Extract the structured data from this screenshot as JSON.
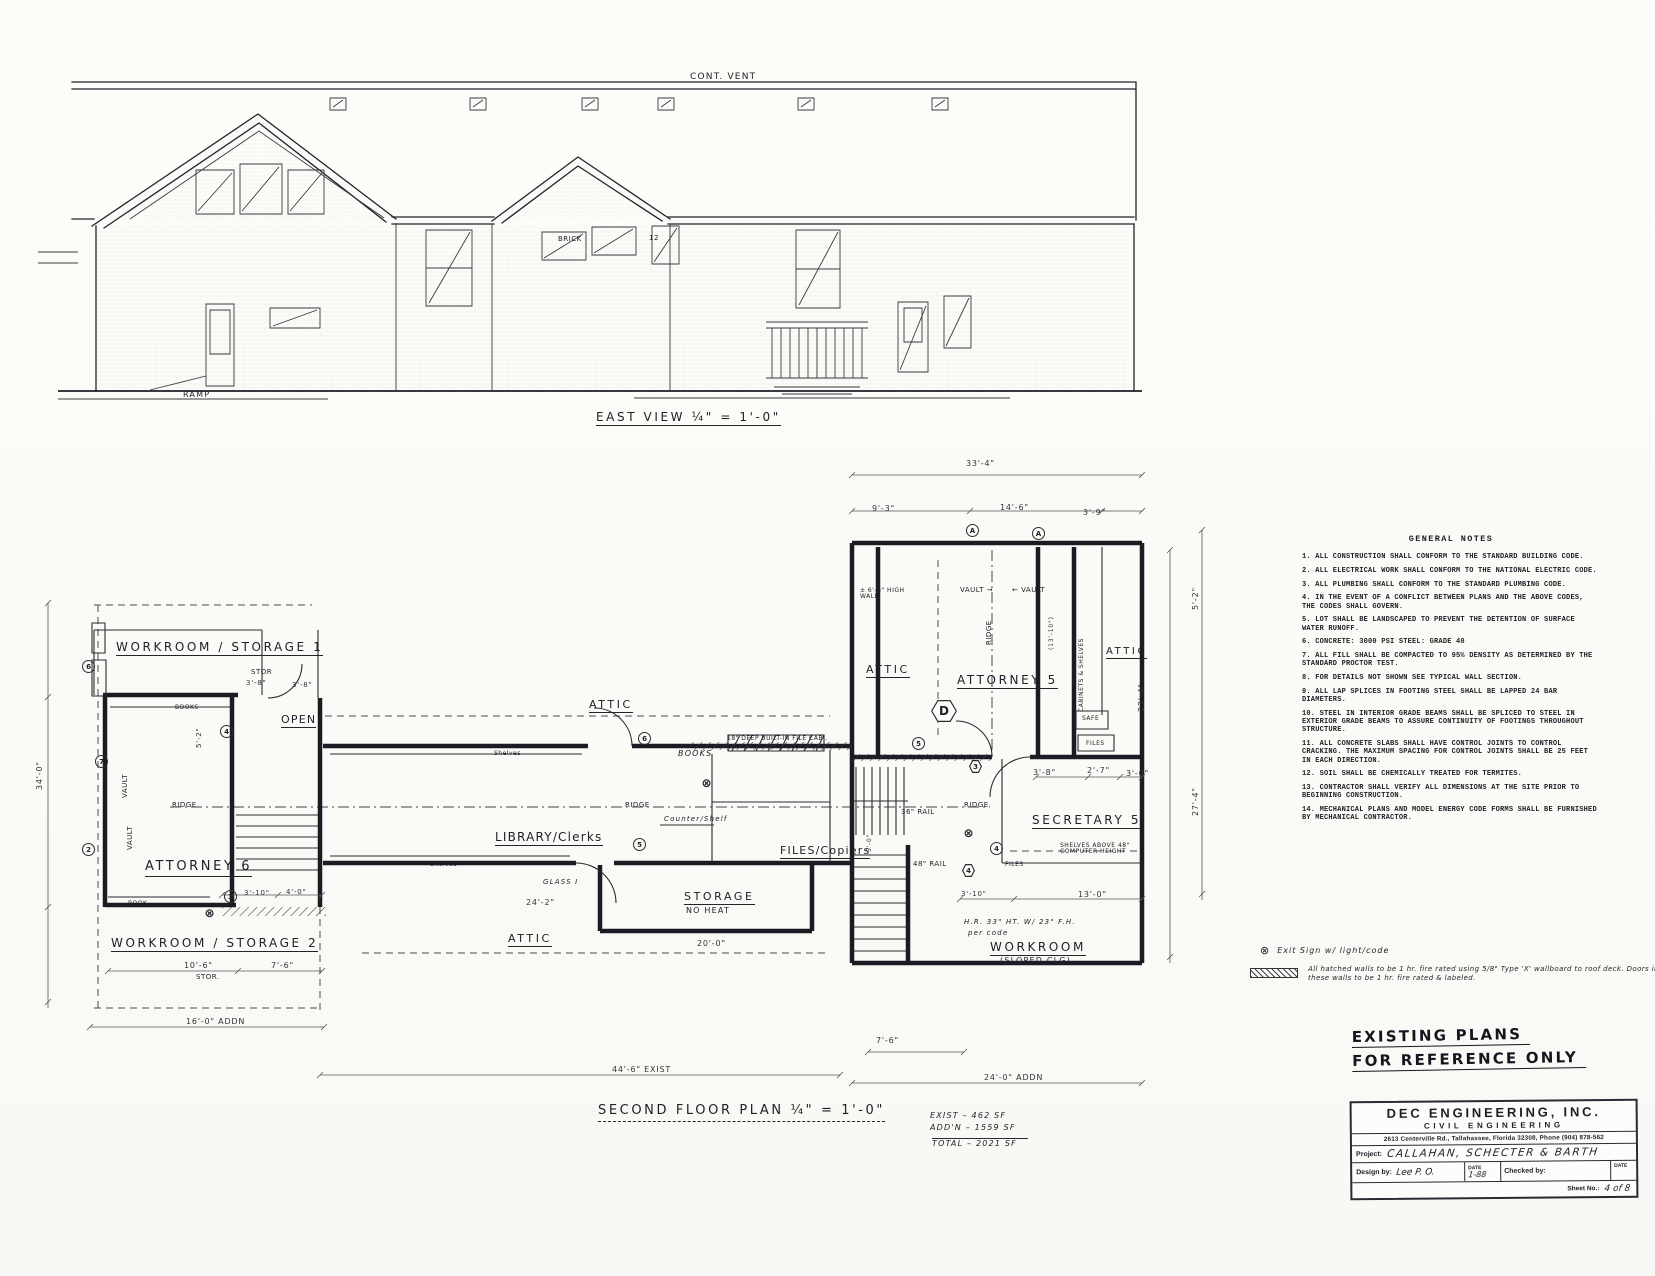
{
  "colors": {
    "ink": "#22222a",
    "paper": "#fbfbf8"
  },
  "general_notes": {
    "title": "GENERAL NOTES",
    "items": [
      "1.  ALL CONSTRUCTION SHALL CONFORM TO THE STANDARD BUILDING CODE.",
      "2.  ALL ELECTRICAL WORK SHALL CONFORM TO THE NATIONAL ELECTRIC CODE.",
      "3.  ALL PLUMBING SHALL CONFORM TO THE STANDARD PLUMBING CODE.",
      "4.  IN THE EVENT OF A CONFLICT BETWEEN PLANS AND THE ABOVE CODES, THE CODES SHALL GOVERN.",
      "5.  LOT SHALL BE LANDSCAPED TO PREVENT THE DETENTION OF SURFACE WATER RUNOFF.",
      "6.  CONCRETE: 3000 PSI    STEEL: GRADE 40",
      "7.  ALL FILL SHALL BE COMPACTED TO 95% DENSITY AS DETERMINED BY THE STANDARD PROCTOR TEST.",
      "8.  FOR DETAILS NOT SHOWN SEE TYPICAL WALL SECTION.",
      "9.  ALL LAP SPLICES IN FOOTING STEEL SHALL BE LAPPED 24 BAR DIAMETERS.",
      "10. STEEL IN INTERIOR GRADE BEAMS SHALL BE SPLICED TO STEEL IN EXTERIOR GRADE BEAMS TO ASSURE CONTINUITY OF FOOTINGS THROUGHOUT STRUCTURE.",
      "11. ALL CONCRETE SLABS SHALL HAVE CONTROL JOINTS TO CONTROL CRACKING.  THE MAXIMUM SPACING FOR CONTROL JOINTS SHALL BE 25 FEET IN EACH DIRECTION.",
      "12. SOIL SHALL BE CHEMICALLY TREATED FOR TERMITES.",
      "13. CONTRACTOR SHALL VERIFY ALL DIMENSIONS AT THE SITE PRIOR TO BEGINNING CONSTRUCTION.",
      "14. MECHANICAL PLANS AND MODEL ENERGY CODE FORMS SHALL BE FURNISHED BY MECHANICAL CONTRACTOR."
    ]
  },
  "legend": {
    "exit_symbol": "⊗",
    "exit_text": "Exit Sign w/ light/code",
    "hatch_text": "All hatched walls to be 1 hr. fire rated using 5/8\" Type 'X' wallboard to roof deck.  Doors in these walls to be 1 hr. fire rated & labeled."
  },
  "stamp": {
    "line1": "EXISTING PLANS",
    "line2": "FOR REFERENCE ONLY"
  },
  "title_block": {
    "company": "DEC  ENGINEERING,  INC.",
    "dept": "CIVIL ENGINEERING",
    "address": "2613 Centerville Rd., Tallahassee, Florida 32308, Phone (904) 878-562",
    "project_label": "Project:",
    "project": "CALLAHAN, SCHECTER & BARTH",
    "design_label": "Design by:",
    "design_sig": "Lee P. O.",
    "date_label": "DATE",
    "date_value": "1-88",
    "checked_label": "Checked by:",
    "date2_label": "DATE",
    "sheet_label": "Sheet No.:",
    "sheet_value": "4 of 8"
  },
  "area_summary": {
    "exist": "462 SF",
    "addition": "1559 SF",
    "total": "2021 SF"
  },
  "labels": [
    {
      "t": "CONT. VENT",
      "x": 690,
      "y": 72,
      "fs": 9,
      "cls": "hand"
    },
    {
      "t": "EAST VIEW  ¼\" = 1'-0\"",
      "x": 596,
      "y": 411,
      "fs": 12,
      "cls": "hand sp ul"
    },
    {
      "t": "RAMP",
      "x": 183,
      "y": 391,
      "fs": 8,
      "cls": "hand"
    },
    {
      "t": "12",
      "x": 649,
      "y": 235,
      "fs": 7
    },
    {
      "t": "BRICK",
      "x": 558,
      "y": 236,
      "fs": 7
    },
    {
      "t": "SECOND FLOOR PLAN  ¼\" = 1'-0\"",
      "x": 598,
      "y": 1104,
      "fs": 13,
      "cls": "hand sp ud"
    },
    {
      "t": "WORKROOM / STORAGE  1",
      "x": 116,
      "y": 641,
      "fs": 12,
      "cls": "hand sp ul"
    },
    {
      "t": "OPEN",
      "x": 281,
      "y": 714,
      "fs": 11,
      "cls": "hand ul"
    },
    {
      "t": "ATTORNEY 6",
      "x": 145,
      "y": 860,
      "fs": 13,
      "cls": "hand sp ul"
    },
    {
      "t": "WORKROOM / STORAGE  2",
      "x": 111,
      "y": 937,
      "fs": 12,
      "cls": "hand sp ul"
    },
    {
      "t": "ATTIC",
      "x": 589,
      "y": 699,
      "fs": 11,
      "cls": "hand sp ul"
    },
    {
      "t": "ATTIC",
      "x": 508,
      "y": 933,
      "fs": 11,
      "cls": "hand sp ul"
    },
    {
      "t": "LIBRARY/Clerks",
      "x": 495,
      "y": 831,
      "fs": 12,
      "cls": "hand ul"
    },
    {
      "t": "STORAGE",
      "x": 684,
      "y": 891,
      "fs": 11,
      "cls": "hand sp ul"
    },
    {
      "t": "NO HEAT",
      "x": 686,
      "y": 907,
      "fs": 8,
      "cls": "hand"
    },
    {
      "t": "FILES/Copiers",
      "x": 780,
      "y": 845,
      "fs": 11,
      "cls": "hand ul"
    },
    {
      "t": "ATTIC",
      "x": 866,
      "y": 664,
      "fs": 11,
      "cls": "hand sp ul"
    },
    {
      "t": "ATTORNEY  5",
      "x": 957,
      "y": 674,
      "fs": 12,
      "cls": "hand sp ul"
    },
    {
      "t": "ATTIC",
      "x": 1106,
      "y": 646,
      "fs": 10,
      "cls": "hand sp ul"
    },
    {
      "t": "SECRETARY  5",
      "x": 1032,
      "y": 814,
      "fs": 12,
      "cls": "hand sp ul"
    },
    {
      "t": "WORKROOM",
      "x": 990,
      "y": 941,
      "fs": 12,
      "cls": "hand sp ul"
    },
    {
      "t": "(SLOPED CLG)",
      "x": 1000,
      "y": 957,
      "fs": 8,
      "cls": "hand"
    },
    {
      "t": "STOR",
      "x": 251,
      "y": 669,
      "fs": 7
    },
    {
      "t": "3'-8\"",
      "x": 246,
      "y": 680,
      "fs": 7,
      "cls": "dim"
    },
    {
      "t": "3'-8\"",
      "x": 292,
      "y": 682,
      "fs": 7,
      "cls": "dim"
    },
    {
      "t": "BOOKS",
      "x": 175,
      "y": 705,
      "fs": 6
    },
    {
      "t": "BOOKS",
      "x": 678,
      "y": 750,
      "fs": 8,
      "cls": "hand it"
    },
    {
      "t": "18\" DEEP BUILT-IN FILE CABI.",
      "x": 727,
      "y": 736,
      "fs": 6
    },
    {
      "t": "RIDGE",
      "x": 172,
      "y": 802,
      "fs": 7
    },
    {
      "t": "RIDGE",
      "x": 625,
      "y": 802,
      "fs": 7
    },
    {
      "t": "RIDGE",
      "x": 964,
      "y": 802,
      "fs": 7
    },
    {
      "t": "RIDGE",
      "x": 986,
      "y": 645,
      "fs": 7,
      "cls": "rot"
    },
    {
      "t": "VAULT",
      "x": 122,
      "y": 798,
      "fs": 7,
      "cls": "rot"
    },
    {
      "t": "VAULT",
      "x": 127,
      "y": 850,
      "fs": 7,
      "cls": "rot"
    },
    {
      "t": "VAULT →",
      "x": 960,
      "y": 587,
      "fs": 7
    },
    {
      "t": "← VAULT",
      "x": 1012,
      "y": 587,
      "fs": 7
    },
    {
      "t": "± 6'-6\" HIGH WALL",
      "x": 860,
      "y": 588,
      "fs": 6,
      "w": 60,
      "cls": "wrap"
    },
    {
      "t": "CABINETS & SHELVES",
      "x": 1079,
      "y": 712,
      "fs": 6,
      "cls": "rot"
    },
    {
      "t": "SAFE",
      "x": 1082,
      "y": 716,
      "fs": 6
    },
    {
      "t": "FILES",
      "x": 1086,
      "y": 741,
      "fs": 6
    },
    {
      "t": "FILES",
      "x": 1005,
      "y": 862,
      "fs": 6
    },
    {
      "t": "SHELVES ABOVE 48\" COMPUTER HEIGHT",
      "x": 1060,
      "y": 843,
      "fs": 6,
      "w": 80,
      "cls": "wrap"
    },
    {
      "t": "36\" RAIL",
      "x": 901,
      "y": 809,
      "fs": 7
    },
    {
      "t": "48\" RAIL",
      "x": 913,
      "y": 861,
      "fs": 7
    },
    {
      "t": "H.R. 33\" HT. W/ 23\" F.H.",
      "x": 964,
      "y": 919,
      "fs": 7,
      "cls": "hand it"
    },
    {
      "t": "per code",
      "x": 968,
      "y": 930,
      "fs": 7,
      "cls": "hand it"
    },
    {
      "t": "Counter/Shelf",
      "x": 664,
      "y": 816,
      "fs": 7,
      "cls": "hand it"
    },
    {
      "t": "GLASS I",
      "x": 543,
      "y": 879,
      "fs": 7,
      "cls": "hand it"
    },
    {
      "t": "Shelves",
      "x": 430,
      "y": 862,
      "fs": 6
    },
    {
      "t": "Shelves",
      "x": 494,
      "y": 751,
      "fs": 6
    },
    {
      "t": "BOOK",
      "x": 128,
      "y": 901,
      "fs": 6
    },
    {
      "t": "STOR.",
      "x": 196,
      "y": 974,
      "fs": 7
    },
    {
      "t": "33'-4\"",
      "x": 966,
      "y": 460,
      "fs": 8,
      "cls": "dim"
    },
    {
      "t": "9'-3\"",
      "x": 872,
      "y": 505,
      "fs": 8,
      "cls": "dim"
    },
    {
      "t": "14'-6\"",
      "x": 1000,
      "y": 504,
      "fs": 8,
      "cls": "dim"
    },
    {
      "t": "3'-9\"",
      "x": 1083,
      "y": 509,
      "fs": 8,
      "cls": "dim"
    },
    {
      "t": "5'-2\"",
      "x": 196,
      "y": 748,
      "fs": 7,
      "cls": "dim rot"
    },
    {
      "t": "16'-0\"  ADDN",
      "x": 186,
      "y": 1018,
      "fs": 8,
      "cls": "dim"
    },
    {
      "t": "44'-6\"    EXIST",
      "x": 612,
      "y": 1066,
      "fs": 8,
      "cls": "dim"
    },
    {
      "t": "24'-0\"  ADDN",
      "x": 984,
      "y": 1074,
      "fs": 8,
      "cls": "dim"
    },
    {
      "t": "7'-6\"",
      "x": 876,
      "y": 1037,
      "fs": 8,
      "cls": "dim"
    },
    {
      "t": "10'-6\"",
      "x": 184,
      "y": 962,
      "fs": 8,
      "cls": "dim"
    },
    {
      "t": "7'-6\"",
      "x": 271,
      "y": 962,
      "fs": 8,
      "cls": "dim"
    },
    {
      "t": "24'-2\"",
      "x": 526,
      "y": 899,
      "fs": 8,
      "cls": "dim"
    },
    {
      "t": "20'-0\"",
      "x": 697,
      "y": 940,
      "fs": 8,
      "cls": "dim"
    },
    {
      "t": "13'-0\"",
      "x": 1078,
      "y": 891,
      "fs": 8,
      "cls": "dim"
    },
    {
      "t": "3'-10\"",
      "x": 961,
      "y": 891,
      "fs": 7,
      "cls": "dim"
    },
    {
      "t": "3'-8\"",
      "x": 1033,
      "y": 769,
      "fs": 8,
      "cls": "dim"
    },
    {
      "t": "2'-7\"",
      "x": 1087,
      "y": 767,
      "fs": 8,
      "cls": "dim"
    },
    {
      "t": "3'-0\"",
      "x": 1126,
      "y": 770,
      "fs": 8,
      "cls": "dim"
    },
    {
      "t": "3'-10\"",
      "x": 244,
      "y": 890,
      "fs": 7,
      "cls": "dim"
    },
    {
      "t": "4'-0\"",
      "x": 286,
      "y": 889,
      "fs": 7,
      "cls": "dim"
    },
    {
      "t": "34'-0\"",
      "x": 36,
      "y": 790,
      "fs": 8,
      "cls": "dim rot"
    },
    {
      "t": "23'-4\"",
      "x": 1138,
      "y": 712,
      "fs": 8,
      "cls": "dim rot"
    },
    {
      "t": "27'-4\"",
      "x": 1192,
      "y": 816,
      "fs": 8,
      "cls": "dim rot"
    },
    {
      "t": "5'-2\"",
      "x": 1192,
      "y": 610,
      "fs": 8,
      "cls": "dim rot"
    },
    {
      "t": "5'-0\"",
      "x": 867,
      "y": 852,
      "fs": 6,
      "cls": "dim rot"
    },
    {
      "t": "(13'-10\")",
      "x": 1049,
      "y": 650,
      "fs": 6,
      "cls": "dim rot"
    },
    {
      "t": "EXIST  –    462 SF",
      "x": 930,
      "y": 1112,
      "fs": 8,
      "cls": "hand it"
    },
    {
      "t": "ADD'N  –  1559 SF",
      "x": 930,
      "y": 1124,
      "fs": 8,
      "cls": "hand it"
    },
    {
      "t": "TOTAL –  2021 SF",
      "x": 932,
      "y": 1138,
      "fs": 8,
      "w": 96,
      "cls": "hand it tl"
    }
  ],
  "tags": [
    {
      "t": "A",
      "x": 966,
      "y": 524
    },
    {
      "t": "A",
      "x": 1032,
      "y": 527
    },
    {
      "t": "6",
      "x": 82,
      "y": 660
    },
    {
      "t": "7",
      "x": 95,
      "y": 755
    },
    {
      "t": "2",
      "x": 82,
      "y": 843
    },
    {
      "t": "4",
      "x": 220,
      "y": 725
    },
    {
      "t": "3",
      "x": 224,
      "y": 890
    },
    {
      "t": "6",
      "x": 638,
      "y": 732
    },
    {
      "t": "5",
      "x": 633,
      "y": 838
    },
    {
      "t": "5",
      "x": 912,
      "y": 737
    },
    {
      "t": "4",
      "x": 990,
      "y": 842
    },
    {
      "t": "3",
      "x": 969,
      "y": 760,
      "cls": "hex"
    },
    {
      "t": "4",
      "x": 962,
      "y": 864,
      "cls": "hex"
    },
    {
      "t": "D",
      "x": 931,
      "y": 700,
      "cls": "hex big"
    },
    {
      "t": "⊗",
      "x": 700,
      "y": 776,
      "cls": "bare"
    },
    {
      "t": "⊗",
      "x": 962,
      "y": 826,
      "cls": "bare"
    },
    {
      "t": "⊗",
      "x": 203,
      "y": 906,
      "cls": "bare"
    }
  ]
}
